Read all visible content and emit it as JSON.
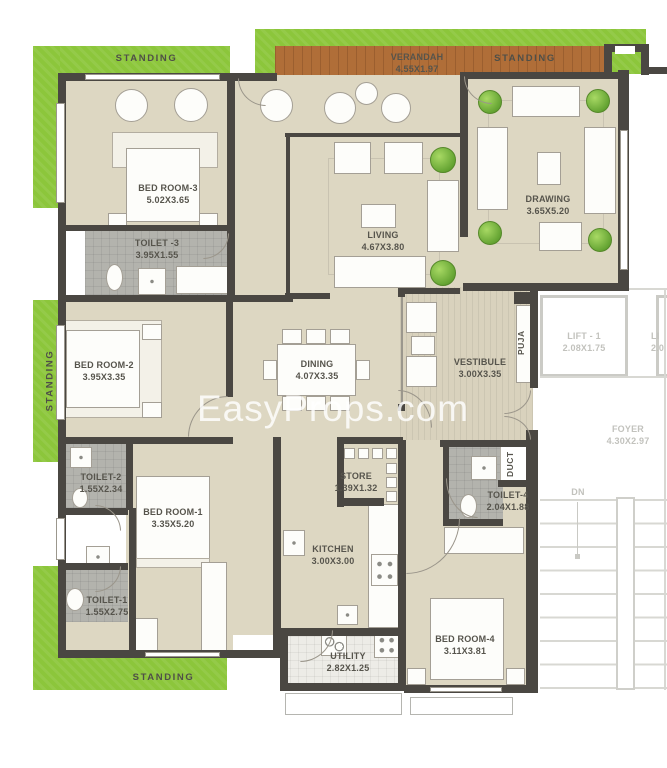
{
  "watermark": "EasyProps.com",
  "outdoor": {
    "standing_top_left": "STANDING",
    "standing_left": "STANDING",
    "standing_bottom": "STANDING",
    "standing_top_right": "STANDING"
  },
  "rooms": {
    "bedroom3": {
      "label": "BED ROOM-3",
      "dims": "5.02X3.65"
    },
    "toilet3": {
      "label": "TOILET -3",
      "dims": "3.95X1.55"
    },
    "bedroom2": {
      "label": "BED ROOM-2",
      "dims": "3.95X3.35"
    },
    "toilet2": {
      "label": "TOILET-2",
      "dims": "1.55X2.34"
    },
    "bedroom1": {
      "label": "BED ROOM-1",
      "dims": "3.35X5.20"
    },
    "toilet1": {
      "label": "TOILET-1",
      "dims": "1.55X2.75"
    },
    "verandah": {
      "label": "VERANDAH",
      "dims": "4.55X1.97"
    },
    "living": {
      "label": "LIVING",
      "dims": "4.67X3.80"
    },
    "drawing": {
      "label": "DRAWING",
      "dims": "3.65X5.20"
    },
    "dining": {
      "label": "DINING",
      "dims": "4.07X3.35"
    },
    "vestibule": {
      "label": "VESTIBULE",
      "dims": "3.00X3.35"
    },
    "puja": {
      "label": "PUJA"
    },
    "store": {
      "label": "STORE",
      "dims": "1.39X1.32"
    },
    "kitchen": {
      "label": "KITCHEN",
      "dims": "3.00X3.00"
    },
    "utility": {
      "label": "UTILITY",
      "dims": "2.82X1.25"
    },
    "bedroom4": {
      "label": "BED ROOM-4",
      "dims": "3.11X3.81"
    },
    "toilet4": {
      "label": "TOILET-4",
      "dims": "2.04X1.88"
    },
    "duct": {
      "label": "DUCT"
    }
  },
  "common_areas": {
    "lift1": {
      "label": "LIFT - 1",
      "dims": "2.08X1.75"
    },
    "lift2_partial": {
      "label": "LI",
      "dims": "2.0"
    },
    "foyer": {
      "label": "FOYER",
      "dims": "4.30X2.97"
    },
    "stair_direction": "DN"
  },
  "colors": {
    "wall": "#4a4742",
    "floor": "#ddd7c2",
    "lawn": "#8cc63b",
    "wood": "#b06e38",
    "tile": "#b3b3ad",
    "watermark_text": "#ffffff"
  }
}
